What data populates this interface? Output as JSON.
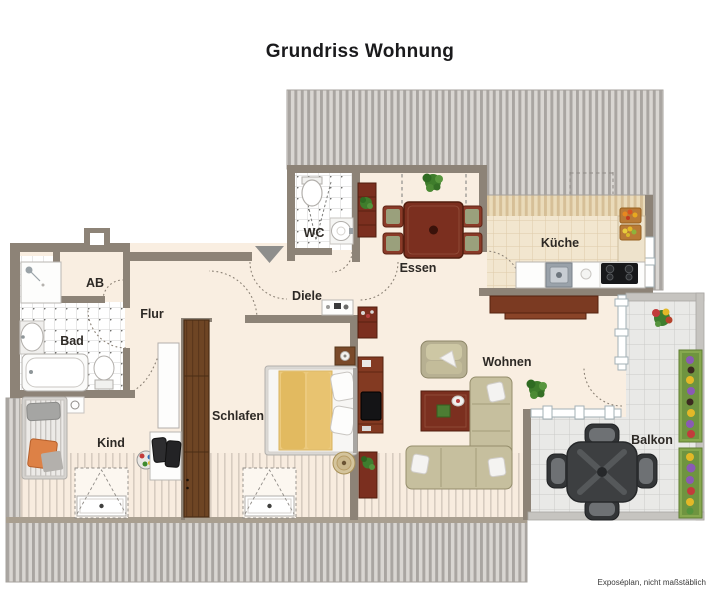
{
  "title": "Grundriss Wohnung",
  "footer_note": "Exposéplan, nicht maßstäblich",
  "rooms": {
    "wc": "WC",
    "ab": "AB",
    "flur": "Flur",
    "bad": "Bad",
    "kind": "Kind",
    "schlafen": "Schlafen",
    "diele": "Diele",
    "essen": "Essen",
    "kueche": "Küche",
    "wohnen": "Wohnen",
    "balkon": "Balkon"
  },
  "colors": {
    "wall": "#8d8377",
    "floor_cream": "#f9eee1",
    "roof_stripe_dark": "#a9a5a1",
    "roof_stripe_light": "#d9d6d2",
    "wood_dark_red": "#7b2f1f",
    "wardrobe_brown": "#6e4524",
    "sofa_beige": "#c6bf9e",
    "blanket_yellow": "#ecca7e",
    "balcony_furniture": "#3d3f41",
    "balcony_wall": "#c6c4c0",
    "glass_frame": "#a3b0b6",
    "entrance_arrow": "#8e8e8c",
    "plant_green": "#3f7d2c"
  }
}
